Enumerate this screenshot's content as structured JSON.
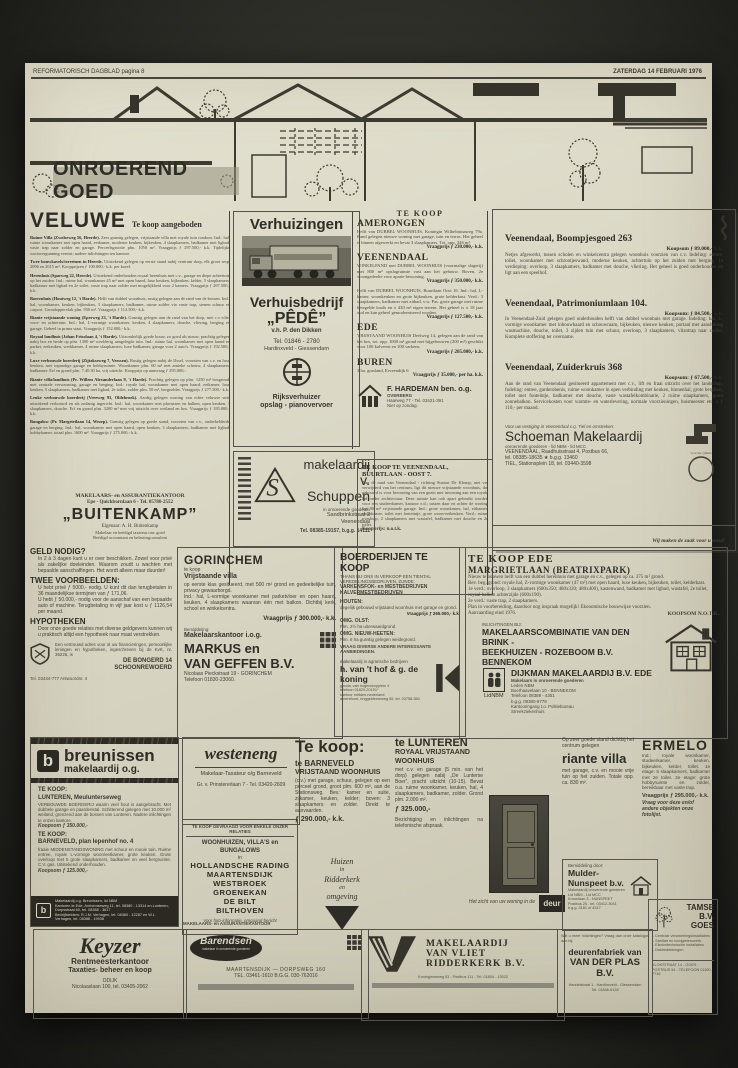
{
  "masthead": {
    "left": "REFORMATORISCH DAGBLAD pagina 8",
    "right": "ZATERDAG 14 FEBRUARI 1976"
  },
  "banner": {
    "title": "ONROEREND GOED"
  },
  "veluwe": {
    "title": "VELUWE",
    "subtitle": "Te koop aangeboden",
    "listings": [
      {
        "lead": "Ruime Villa (Zwolseweg 56, Heerde).",
        "body": "Zeer gunstig gelegen, vrijstaande villa met royale tuin rondom. Ind.: hal, ruime woonkamer met open haard, eetkamer, moderne keuken, bijkeuken, 4 slaapkamers, badkamer met ligbad, vaste trap naar zolder en garage. Perceelsgrootte plm. 1050 m². Vraagprijs ƒ 297.500,- k.k. Tijdelijke woonvergunning vereist; nadere inlichtingen ten kantore."
      },
      {
        "lead": "Twee bouwkavels/terreinen in Heerde.",
        "body": "Uitstekend gelegen op eerste stand nabij centrum dorp, elk groot resp. 2096 en 2615 m². Koopprijzen ƒ 100.000,- k.k. per kavel."
      },
      {
        "lead": "Herenhuis (Sparweg 22, Heerde).",
        "body": "Uitstekend onderhouden royaal herenhuis met c.v., garage en diepe achtertuin op het zuiden. Ind.: ruime hal, woonkamer 45 m² met open haard, luxe keuken, bijkeuken, kelder, 5 slaapkamers, badkamer met ligbad en 2e toilet, vaste trap naar zolder met mogelijkheid voor 2 kamers. Vraagprijs ƒ 267.500,- k.k."
      },
      {
        "lead": "Boerenhuis (Houtweg 12, 't Harde).",
        "body": "Helft van dubbel woonhuis, rustig gelegen aan de rand van de bossen. Ind.: hal, woonkamer, keuken, bijkeuken, 3 slaapkamers, badkamer, ruime zolder via vaste trap, stenen schuur en carport. Grondoppervlak plm. 950 m². Vraagprijs ƒ 112.500,- k.k."
      },
      {
        "lead": "Riante vrijstaande woning (Eperweg 23, 't Harde).",
        "body": "Gunstig gelegen aan de rand van het dorp, met c.v.-olie, voor- en achtertuin. Ind.: hal, L-vormige woonkamer, keuken, 4 slaapkamers, douche, vliering, berging en garage. Geheel in prima staat. Vraagprijs ƒ 152.000,- k.k."
      },
      {
        "lead": "Royaal landhuis (Johan Frisolaan 4, 't Harde).",
        "body": "Uitzonderlijk goede bouw, zo goed als nieuw, prachtig gelegen nabij bos en heide op plm. 1300 m² weelderig aangelegde tuin. Ind.: ruime hal, woonkamer met open haard en parket, eetkeuken, werkkamer, 4 ruime slaapkamers, luxe badkamer, garage voor 2 auto's. Vraagprijs ƒ 192.500,- k.k."
      },
      {
        "lead": "Luxe verbouwde boerderij (Zijtakseweg 7, Veessen).",
        "body": "Rustig gelegen nabij de IJssel, voorzien van c.v. en luxe keuken, met inpandige garage en hobbyruimte. Woonkamer plm. 60 m² met antieke schouw, 4 slaapkamers, badkamer. Erf en grond plm. 7.40.30 ha, vrij uitzicht. Koopprijs op aanvraag ƒ 295.000,-."
      },
      {
        "lead": "Riante villa/landhuis (Pr. Willem Alexanderlaan 9, 't Harde).",
        "body": "Prachtig gelegen op plm. 1250 m² bosgrond, met centrale verwarming, garage en berging. Ind.: royale hal, woonkamer met open haard, eetkamer, luxe keuken, 5 slaapkamers, badkamer met ligbad, 2e toilet, zolder plm. 50 m², bergzolder. Vraagprijs ƒ 277.500,- k.k."
      },
      {
        "lead": "Leuke verbouwde boerderij (Vreeweg 93, Oldebroek).",
        "body": "Aardig gelegen woning van echte veluwse snit, uitstekend verbouwd en als zodanig ingericht. Ind.: hal, woonkamer met plavuizen en balken, open keuken, 3 slaapkamers, douche. Erf en grond plm. 3200 m² met vrij uitzicht over weiland en bos. Vraagprijs ƒ 185.000,- k.k."
      },
      {
        "lead": "Bungalow (Pr. Margrietlaan 14, Wezep).",
        "body": "Gunstig gelegen op goede stand, voorzien van c.v., onderkelderde garage en berging. Ind.: hal, woonkamer met open haard, open keuken, 3 slaapkamers, badkamer met ligbad, hobbykamer, totaal plm. 1600 m². Vraagprijs ƒ 275.000,- k.k."
      }
    ],
    "office": {
      "line1": "MAKELAARS- en ASSURANTIEKANTOOR",
      "line2": "Epe - Quickbornlaan 6 - Tel. 05780-2552",
      "name": "„BUITENKAMP”",
      "owner": "Eigenaar: A. H. Buitenkamp",
      "sub1": "Makelaar en beëdigd taxateur onr. goed",
      "sub2": "Beëdigd accountant en belastingconsulent"
    }
  },
  "verhuizingen": {
    "title": "Verhuizingen",
    "firm": "Verhuisbedrijf",
    "name": "„PÊDÊ”",
    "vh": "v.h. P. den Dikken",
    "tel": "Tel. 01846 - 2780",
    "place": "Hardinxveld - Giessendam",
    "r1": "Rijksverhuizer",
    "r2": "opslag - pianovervoer"
  },
  "schuppen": {
    "logo": "S",
    "n1": "makelaardij",
    "n2": "v. Schuppen",
    "sub": "in onroerende goederen",
    "a1": "Sandbrinkstraat 2",
    "a2": "Veenendaal",
    "tel": "Tel. 08385-19157, b.g.g. 14111"
  },
  "tekoop": {
    "header": "TE KOOP",
    "amerongen_h": "AMERONGEN",
    "amerongen": "Helft van DUBBEL WOONHUIS, Koningin Wilhelminaweg 79a. Rand gelegen nieuwe woning met garage, tuin en terras. Het geheel is binnen afgewerkt en bevat 3 slaapkamers. Tot. opp. 346 m²",
    "amerongen_p": "Vraagprijs ƒ 230.000,- k.k.",
    "veenendaal_h": "VEENENDAAL",
    "veenendaal1": "WINKELPAND met DUBBEL WOONHUIS (voormalige slagerij) met 800 m² opslagruimte vast aan het gebouw. Boven, 2e woongedeelte voor aparte bewoning.",
    "veenendaal1_p": "Vraagprijs ƒ 350.000,- k.k.",
    "veenendaal2": "Helft van DUBBEL WOONHUIS, Buurtlaan Oost 16. Ind.: hal, L-kamer, woonkeuken en grote bijkeuken, grote kelderkast. Verd.: 3 slaapkamers, badkamer met zitbad, v.w. Pas. grote garage met ruime betegelde loods en ± 430 m² eigen terrein. Het geheel is ± 18 jaar oud en kan geheel gemoderniseerd worden.",
    "veenendaal2_p": "Vraagprijs ƒ 127.500,- k.k.",
    "ede_h": "EDE",
    "ede": "VRIJSTAAND WOONHUIS Deelweg 14, gelegen aan de rand van het bos, tot. opp. 1000 m² grond met bijgebouwen (200 m²) geschikt voor 100 kalveren en 100 varkens.",
    "ede_p": "Vraagprijs ƒ 205.000,- k.k.",
    "buren_h": "BUREN",
    "buren": "3 ha. grasland, Erveendijk 6",
    "buren_p": "Vraagprijs ƒ 35.000,- per ha. k.k.",
    "hardeman": {
      "name": "F. HARDEMAN ben. o.g.",
      "place": "OVERBERG",
      "addr": "Haarweg 77 - Tel. 03421-391",
      "note": "Niet op zondag."
    },
    "buurtlaan": {
      "t1": "TE KOOP TE VEENENDAAL,",
      "t2": "BUURTLAAN - OOST 7.",
      "body": "Aan de rand van Veenendaal - richting Station De Klomp, niet ver verwijderd van het centrum, ligt dit nieuwe vrijstaande woonhuis, dat gebouwd is voor bewoning van een gezin met inwoning aan een royale hal onder architectuur. Deze ruimte kan ook apart gebruikt worden voor een studeerkamer, kantoor e.d.; tussen daar en achter de woning ligt 90 m² vrijstaande garage. Ind.: grote woonkamer, hal, zitkamer, slaapkamer, toilet met fonteintje, grote woon-eetkeuken. Verd.: ruime overloop, 2 slaapkamers met wastafel, badkamer met douche en 2e toilet.",
      "price": "Koopprijs: n.o.t.k."
    }
  },
  "vbox": {
    "l1h": "Veenendaal, Boompjesgoed 263",
    "l1p": "Koopsom ƒ 89.000,- k.k.",
    "l1": "Netjes afgewerkt, tussen scholen en winkelcentra gelegen woonhuis voorzien van c.v. Indeling: entree, toilet, woonkamer met schrootjeswand, moderne keuken, achtertuin op het zuiden met berging. 1e verdieping: overloop, 3 slaapkamers, badkamer met douche, vliering. Het geheel is goed onderhouden en ligt aan een speelhof.",
    "l2h": "Veenendaal, Patrimoniumlaan 104.",
    "l2p": "Koopsom: ƒ 84.500,- k.k.",
    "l2": "In Veenendaal-Zuid gelegen goed onderhouden helft van dubbel woonhuis met garage. Indeling: hal, L-vormige woonkamer met inbouwhaard en schouwraam, bijkeuken, nieuwe keuken, portaal met aansluiting wasmachine, douche, toilet, 3 zijden tuin met schuur, overloop, 3 slaapkamers, vlizotrap naar zolder. Komplete stoffering ter overname.",
    "l3h": "Veenendaal, Zuiderkruis 368",
    "l3p": "Koopsom: ƒ 67.500,- k.k.",
    "l3": "Aan de rand van Veenendaal gesitueerd appartement met c.v., lift en fraai uitzicht over het landschap. Indeling: entree, garderobenis, ruime woonkamer in open verbinding met keuken, binnenhal, grote bergkast, toilet met fonteintje, badkamer met douche, vaste wastafelkombinatie, 2 ruime slaapkamers, groot zonnebalkon. Servicekosten voor warmte- en waterlevering, normale voorzieningen, huismeester etc. ± ƒ 110,- per maand.",
    "intro": "Voor uw vestiging in Veenendaal c.q. Tiel en omstreken:",
    "name": "Schoeman Makelaardij",
    "sub": "onroerende goederen - lid NBM - lid MCC",
    "a1": "VEENENDAAL, Raadhuisstraat 4, Postbus 66,",
    "a2": "tel. 08385-18635 ★ b.g.g. 13460",
    "a3": "TIEL, Stationsplein 18, tel. 03440-3598",
    "logocap": "voor uw (t)huis",
    "slogan": "Wij maken de zaak voor u rond!"
  },
  "geld": {
    "h1": "GELD NODIG?",
    "p1": "In 2 à 3 dagen kunt u er over beschikken. Zowel voor privé als zakelijke doeleinden. Waarom zoudt u wachten met bepaalde aanschaffingen. Het wordt alleen maar duurder!",
    "h2": "TWEE VOORBEELDEN:",
    "p2": "U hebt privé ƒ 5000,- nodig. U kunt dit dan terugbetalen in 36 maandelijkse termijnen van ƒ 171,06.",
    "p3": "U hebt ƒ 50.000,- nodig voor de aanschaf van een bepaalde auto of machine. Terugbetaling in vijf jaar kost u ƒ 1126,54 per maand.",
    "h3": "HYPOTHEKEN",
    "p4": "Door onze goede relaties met diverse geldgevers kunnen wij u praktisch altijd een hypotheek naar maat verstrekken.",
    "side": "Een vertrouwd adres voor al uw financieringen, persoonlijke leningen en hypotheken, ingeschreven bij de KvK, nr. 36226, is",
    "a1": "DE BONGERD 14",
    "a2": "SCHOONREWOERD",
    "tel": "Tel. 03434-777 Antwoordnr. 4"
  },
  "gorinchem": {
    "title": "GORINCHEM",
    "sub": "te koop",
    "kind": "Vrijstaande villa",
    "body": "op eerste klas gesitueerd, met 500 m² grond en gedeeltelijke tuin, privacy gewaarborgd.",
    "body2": "Ind.: hal, L-vormige woonkamer met parketvloer en open haard, keuken, 4 slaapkamers waarvan één met balkon. Dichtbij kerk, school en winkelcentra.",
    "price": "Vraagprijs ƒ 300.000,- k.k.",
    "bem": "Bemiddeling:",
    "k1": "Makelaarskantoor i.o.g.",
    "k2": "MARKUS en",
    "k3": "VAN GEFFEN B.V.",
    "a1": "Nicolaas Pieckstraat 19 - GORINCHEM",
    "a2": "Telefoon 01830-23060."
  },
  "boerderijen": {
    "title": "BOERDERIJEN TE KOOP",
    "intro": "THANS BIJ ONS IN VERKOOP EEN TIENTAL VEREDELINGSBEDRIJVEN, ZIJNDE:",
    "b1": "VARKENSFOK- en MESTBEDRIJVEN",
    "b2": "KALVERMESTBEDRIJVEN",
    "h1": "HOUTEN:",
    "t1": "degelijk gebouwd vrijstaand woonhuis met garage en grond.",
    "p1": "Vraagprijs ƒ 265.000,- k.k.",
    "h2": "OMG. OLST:",
    "t2": "Plm. 2½ ha uiterwaardgrond.",
    "h3": "OMG. NIEUW-HEETEN:",
    "t3": "Plm. 6 ha gunstig gelegen weidegrond.",
    "b3": "VRAAG DIVERSE ANDERE INTERESSANTE AANBIEDINGEN.",
    "firm1": "makelaardij in agrarische bedrijven",
    "firm2": "h. van 't hof & g. de koning",
    "a1": "gouda, van hogendorpplein 4",
    "a2": "telefoon 01820-20151*",
    "a3": "kantoor midden-nederland:",
    "a4": "amersfoort, ringgelderseweg 55, tel. 03758-350"
  },
  "margriet": {
    "title": "TE KOOP EDE",
    "sub": "MARGRIETLAAN (BEATRIXPARK)",
    "p1": "Nieuw te bouwen helft van een dubbel herenhuis met garage en c.v., gelegen op ca. 375 m² grond.",
    "p2": "Bev. beg. grond: royale hal, Z-vormige woonkamer (47 m²) met open haard, luxe keuken, bijkeuken, toilet, kelderkast.",
    "p3": "1e verd.: overloop, 3 slaapkamers (600x350; 480x320; 480x400), kastenwand, badkamer met ligbad, wastafel, 2e toilet, royaal balkon achterzijde (600x190).",
    "p4": "2e verd.: vaste trap, 2 slaapkamers.",
    "p5": "Plan in voorbereiding, daardoor nog inspraak mogelijk! Ekonomische bouwwijze voorzien.",
    "p6": "Aanvaarding eind 1976.",
    "koopsom": "KOOPSOM N.O.T.K.",
    "inl": "INLICHTINGEN BIJ:",
    "c1": "MAKELAARSCOMBINATIE  VAN DEN BRINK -",
    "c2": "BEEKHUIZEN - ROZEBOOM B.V.  BENNEKOM",
    "c3": "DIJKMAN MAKELAARDIJ B.V. EDE",
    "d1": "Makelaars in onroerende goederen",
    "d2": "Leden NBM",
    "d3": "Boerhaavelaan 10 - BENNEKOM",
    "d4": "Telefoon 08389 - 4351",
    "d5": "b.g.g. 08380-6779",
    "d6": "Kantooringang t.o. Politiebureau",
    "d7": "Streekziekenhuis",
    "nbm": "LidNBM"
  },
  "breunissen": {
    "logo": "b",
    "name": "breunissen",
    "sub": "makelaardij o.g.",
    "l1h": "TE KOOP:",
    "l1a": "LUNTEREN, Meulunterseweg",
    "l1": "VERBOUWDE BOERDERIJ waarin veel hout is aangebracht. Met dubbele garage en paardenstal. Schitterend gelegen met 10.000 m² weiland, grenzend aan de bossen van Lunteren. Nadere inlichtingen te onzen kantore.",
    "l1p": "Koopsom ƒ 350.000,-",
    "l2h": "TE KOOP:",
    "l2a": "BARNEVELD, plan Iepenhof no. 4",
    "l2": "fraaie MIDDENSTANDSWONING met schuur en mooie tuin. Ruime entree, royale L-vormige woon/eetkamer, grote keuken. Grote overloop met 5 grote slaapkamers, badkamer en veel bergruimte. C.V. gas. Uitstekend onderhouden.",
    "l2p": "Koopsom ƒ 125.000,-",
    "f1": "Makelaardij o.g. Breunissen, lid NBM",
    "f2": "Kantoren te Ede, Arnhemseweg 11, tel. 08380 - 13314 en Lunteren, Dorpsstraat 60, tel. 08388 - 3617",
    "f3": "Bedrijfsleiders: R.J.M. Verhagen, tel. 08380 - 12287 en W.L. Verhagen, tel. 08388 - 19938"
  },
  "westeneng": {
    "name": "westeneng",
    "sub": "Makelaar-Taxateur o/g Barneveld",
    "addr": "Gr. v. Prinstererlaan 7 - Tel. 03420-2609"
  },
  "gevraagd": {
    "top": "TE KOOP GEVRAAGD VOOR ENKELE ONZER RELATIES",
    "line1": "WOONHUIZEN, VILLA'S en BUNGALOWS",
    "conj": "in",
    "places": [
      "HOLLANDSCHE RADING",
      "MAARTENSDIJK",
      "WESTBROEK",
      "GROENEKAN",
      "DE BILT",
      "BILTHOVEN"
    ],
    "foot": "Voor foto-informatie, omgaand bericht"
  },
  "barneveld": {
    "big": "Te koop:",
    "h": "te BARNEVELD",
    "kind": "VRIJSTAAND WOONHUIS",
    "body": "(c.v.) met garage, schuur, gelegen op een perceel grond, groot plm. 600 m², aan de Stationsweg. Bev.: kamer en suite, zijkamer, keuken, kelder; boven: 3 slaapkamers en zolder. Direkt te aanvaarden.",
    "price": "ƒ 290.000,- k.k."
  },
  "ridderkerk": {
    "l1": "Huizen",
    "l2": "in",
    "l3": "Ridderkerk",
    "l4": "en",
    "l5": "omgeving"
  },
  "lunteren": {
    "h": "te LUNTEREN",
    "kind": "ROYAAL VRIJSTAAND WOONHUIS",
    "body": "met c.v. en garage (5 min. van het dorp) gelegen nabij „De Lunterse Boer”, pracht uitzicht (10-15). Bevat o.a. ruime woonkamer, keuken, hal, 4 slaapkamers, badkamer, zolder. Grond plm. 2.000 m².",
    "price": "ƒ 325.000,-",
    "body2": "Bezichtiging en inlichtingen na telefonische afspraak."
  },
  "deur": {
    "caption": "Het zicht van uw woning in de",
    "logo": "deur"
  },
  "ermelo": {
    "title": "ERMELO",
    "intro": "Op zeer goede stand dichtbij het centrum gelegen",
    "kind": "riante villa",
    "left": "met garage, c.v. en mooie vrije tuin op het zuiden. Totale opp. ca. 830 m².",
    "right": "Ind.: royale woonkamer, studeerkamer, keuken, bijkeuken, kelder, toilet. 1e etage: 5 slaapkamers, badkamer met 2e toilet. 2e etage: grote hobbyruimte en zolder, bereikbaar met vaste trap.",
    "price": "Vraagprijs ƒ 295.000,- k.k.",
    "foot": "Vraag voor deze en/of andere objekten onze fotolijst."
  },
  "mulder": {
    "bem": "Bemiddeling door:",
    "name": "Mulder-Nunspeet b.v.",
    "s1": "Makelaardij onroerende goederen",
    "s2": "Lid NBM - Lid MCC",
    "s3": "Kroonlaan 3 - NUNSPEET",
    "s4": "Postbus 25 - tel. 03412-3041",
    "s5": "b.g.g. 3181 of 4317"
  },
  "keyzer": {
    "name": "Keyzer",
    "s1": "Rentmeesterkantoor",
    "s2": "Taxaties- beheer en koop",
    "s3": "ODIJK",
    "s4": "Nicolaaslaan 100, tel. 03405-2062"
  },
  "barendsen": {
    "label": "MAKELAARS- en ASSURANTIEKANTOOR",
    "name": "Barendsen",
    "ovalsub": "makelaar in onroerende goederen",
    "l1": "MAARTENSDIJK  —  DORPSWEG 160",
    "l2": "TEL. 03461-1610   B.G.G. 030-762016"
  },
  "vanvliet": {
    "l1": "MAKELAARDIJ",
    "l2": "VAN VLIET",
    "l3": "RIDDERKERK B.V.",
    "addr": "Koninginneweg 53 - Postbus 111 - Tel. 01804 - 13022"
  },
  "vanderplas": {
    "q": "Wilt u meer inlichtingen? Vraag dan onze katalogus aan bij:",
    "n1": "deurenfabriek van",
    "n2": "VAN DER PLAS B.V.",
    "a1": "Handelstraat 1 - Hardinxveld - Giessendam",
    "a2": "Tel. 01846-6128"
  },
  "tamse": {
    "name": "TAMSE B.V.",
    "place": "GOES",
    "items": [
      "Centrale verwarmingsinstallaties",
      "Sanitair en loodgieterswerk",
      "Electrotechnische installaties",
      "Dakbedekkingen"
    ],
    "a1": "KLOKSTRAAT 14 - GOES",
    "a2": "POSTBUS 54 - TELEFOON 01100-7716"
  }
}
